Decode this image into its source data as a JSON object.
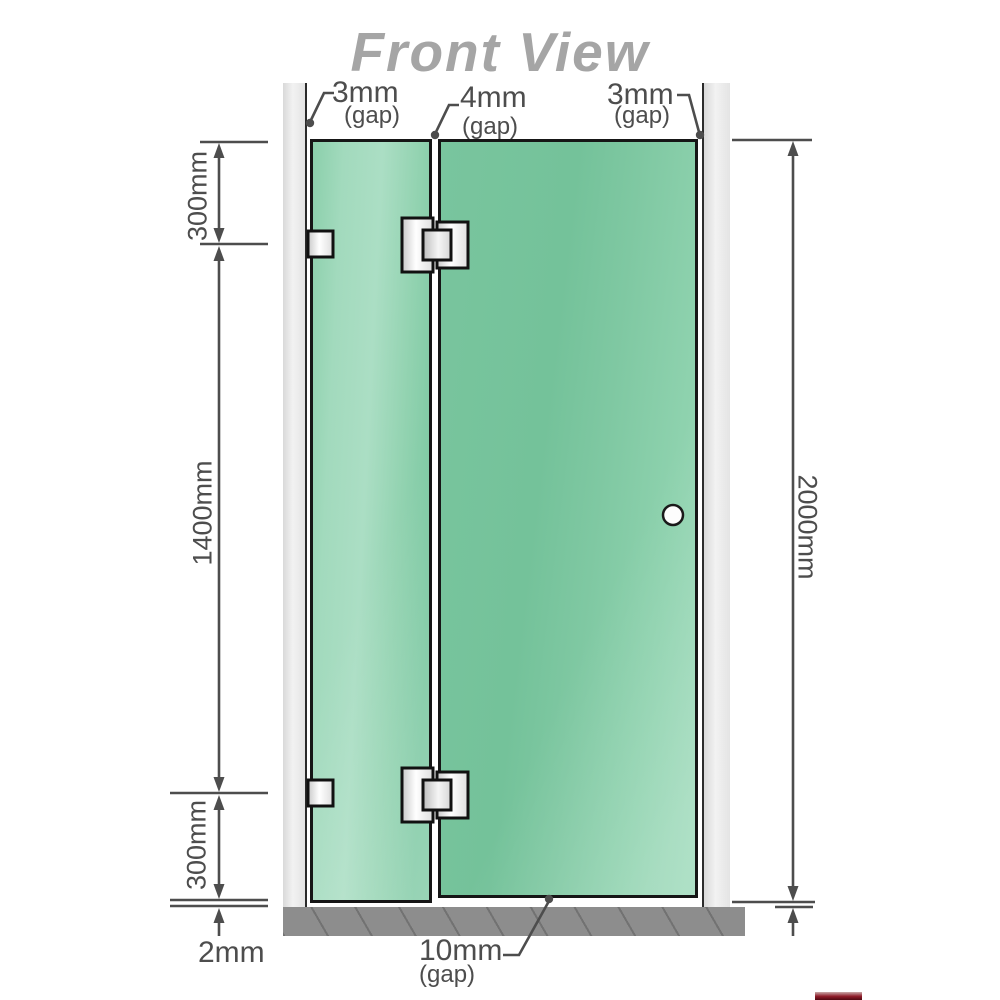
{
  "title": "Front View",
  "annotations": {
    "gap_top_left": {
      "value": "3mm",
      "qualifier": "(gap)"
    },
    "gap_top_middle": {
      "value": "4mm",
      "qualifier": "(gap)"
    },
    "gap_top_right": {
      "value": "3mm",
      "qualifier": "(gap)"
    },
    "gap_bottom": {
      "value": "10mm",
      "qualifier": "(gap)"
    },
    "floor_gap": {
      "value": "2mm"
    }
  },
  "dimensions": {
    "top_segment": "300mm",
    "middle_segment": "1400mm",
    "bottom_segment": "300mm",
    "total_height": "2000mm"
  },
  "colors": {
    "glass": "#7cc8a2",
    "glass_highlight": "#a9ddc2",
    "wall": "#ebebeb",
    "floor": "#8d8d8d",
    "dimension_line": "#4d4d4d",
    "title_text": "#a5a5a5",
    "hardware": "#ededed",
    "outline": "#161616"
  }
}
